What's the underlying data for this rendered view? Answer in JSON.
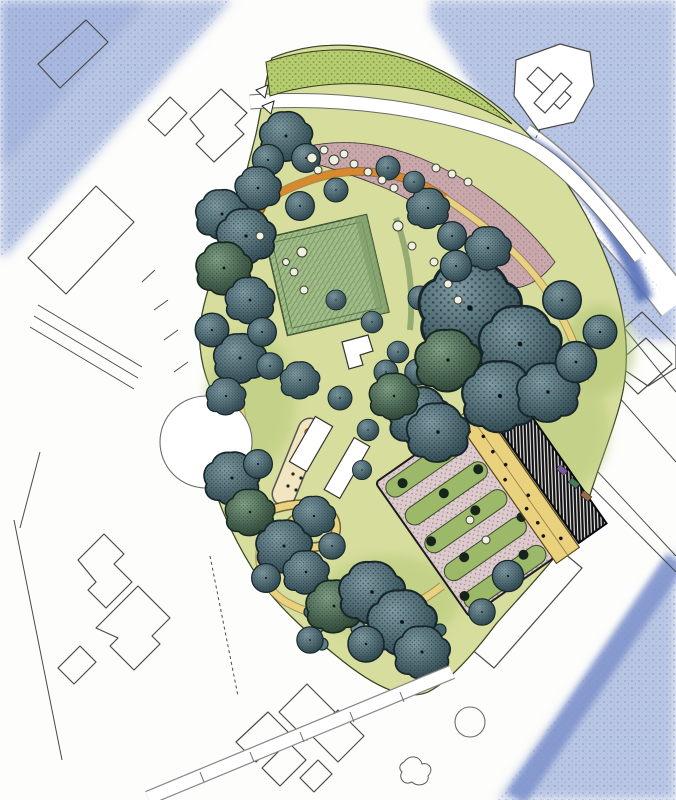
{
  "canvas": {
    "width": 676,
    "height": 800,
    "background": "#fdfdfb"
  },
  "palette": {
    "paper": "#fdfdfb",
    "blue_light": "#b9c6e3",
    "blue_mid": "#8ba0d2",
    "blue_deep": "#5570b8",
    "context_line": "#4a4a46",
    "grass": "#d7dd9c",
    "grass_stipple": "#79883f",
    "bank_green": "#b5cc6f",
    "lawn": "#a3bd88",
    "lawn_hatch": "#6f9160",
    "tree_light": "#7e9aa2",
    "tree_mid": "#4a656d",
    "tree_dark": "#233940",
    "tree_green_light": "#7fa083",
    "tree_green_mid": "#47634f",
    "tree_green_dark": "#24382b",
    "path_yellow": "#ead17d",
    "path_orange": "#d8892d",
    "path_edge": "#6b5a2c",
    "pink_planting": "#c9a6ac",
    "stripe_green": "#9bb968",
    "stripe_pink": "#dccacc",
    "dark_building": "#0d0f16",
    "white": "#ffffff"
  },
  "plan": {
    "type": "hand-rendered-landscape-masterplan",
    "feature_names": [
      "pencil-shaded-surroundings",
      "context-building-blocks",
      "perimeter-roads",
      "park-meadow",
      "event-lawn",
      "entrance-ornamental-planting",
      "winding-orange-path",
      "yellow-park-paths",
      "play-pad",
      "serpentine-mound-path",
      "stripe-garden-beds",
      "terrace-walk",
      "dark-hatched-building",
      "tree-canopies",
      "shrub-masses",
      "roundabout-circle",
      "small-tree-ring"
    ],
    "trees": [
      [
        286,
        136,
        0.8,
        "A"
      ],
      [
        268,
        160,
        0.65,
        "B"
      ],
      [
        306,
        158,
        0.6,
        "B"
      ],
      [
        258,
        188,
        0.7,
        "A"
      ],
      [
        222,
        214,
        0.8,
        "A"
      ],
      [
        246,
        236,
        0.9,
        "A"
      ],
      [
        224,
        268,
        0.85,
        "G"
      ],
      [
        250,
        300,
        0.75,
        "A"
      ],
      [
        212,
        330,
        0.7,
        "B"
      ],
      [
        240,
        358,
        0.8,
        "A"
      ],
      [
        262,
        332,
        0.6,
        "B"
      ],
      [
        270,
        366,
        0.55,
        "B"
      ],
      [
        226,
        396,
        0.6,
        "A"
      ],
      [
        300,
        206,
        0.6,
        "B"
      ],
      [
        336,
        190,
        0.5,
        "B"
      ],
      [
        428,
        208,
        0.65,
        "A"
      ],
      [
        452,
        236,
        0.6,
        "B"
      ],
      [
        336,
        300,
        0.42,
        "B"
      ],
      [
        372,
        322,
        0.45,
        "B"
      ],
      [
        420,
        298,
        0.5,
        "B"
      ],
      [
        398,
        352,
        0.45,
        "B"
      ],
      [
        300,
        380,
        0.6,
        "A"
      ],
      [
        340,
        398,
        0.5,
        "B"
      ],
      [
        368,
        430,
        0.45,
        "B"
      ],
      [
        386,
        372,
        0.5,
        "B"
      ],
      [
        418,
        372,
        0.55,
        "B"
      ],
      [
        470,
        308,
        1.55,
        "A"
      ],
      [
        520,
        344,
        1.25,
        "A"
      ],
      [
        448,
        360,
        1.0,
        "G"
      ],
      [
        500,
        396,
        1.15,
        "A"
      ],
      [
        548,
        392,
        0.95,
        "A"
      ],
      [
        576,
        362,
        0.85,
        "B"
      ],
      [
        562,
        300,
        0.8,
        "B"
      ],
      [
        600,
        332,
        0.7,
        "B"
      ],
      [
        488,
        248,
        0.7,
        "A"
      ],
      [
        456,
        266,
        0.65,
        "B"
      ],
      [
        388,
        168,
        0.5,
        "B"
      ],
      [
        414,
        182,
        0.45,
        "B"
      ],
      [
        420,
        416,
        0.95,
        "A"
      ],
      [
        394,
        396,
        0.75,
        "G"
      ],
      [
        438,
        432,
        0.95,
        "A"
      ],
      [
        314,
        516,
        0.65,
        "A"
      ],
      [
        332,
        546,
        0.55,
        "B"
      ],
      [
        362,
        470,
        0.4,
        "B"
      ],
      [
        232,
        478,
        0.85,
        "A"
      ],
      [
        258,
        464,
        0.6,
        "B"
      ],
      [
        250,
        512,
        0.75,
        "G"
      ],
      [
        284,
        546,
        0.85,
        "A"
      ],
      [
        266,
        578,
        0.6,
        "B"
      ],
      [
        306,
        572,
        0.7,
        "A"
      ],
      [
        334,
        606,
        0.85,
        "G"
      ],
      [
        372,
        592,
        1.0,
        "A"
      ],
      [
        402,
        622,
        1.05,
        "A"
      ],
      [
        366,
        644,
        0.75,
        "B"
      ],
      [
        422,
        652,
        0.85,
        "A"
      ],
      [
        310,
        640,
        0.55,
        "B"
      ],
      [
        508,
        576,
        0.65,
        "B"
      ],
      [
        482,
        612,
        0.55,
        "B"
      ]
    ],
    "shrubs": [
      [
        332,
        596,
        7
      ],
      [
        346,
        588,
        6
      ],
      [
        358,
        600,
        8
      ],
      [
        344,
        614,
        7
      ],
      [
        330,
        626,
        6
      ],
      [
        358,
        628,
        7
      ],
      [
        372,
        616,
        8
      ],
      [
        386,
        604,
        7
      ],
      [
        384,
        628,
        8
      ],
      [
        398,
        616,
        7
      ],
      [
        370,
        640,
        7
      ],
      [
        398,
        640,
        8
      ],
      [
        412,
        628,
        7
      ],
      [
        412,
        652,
        7
      ],
      [
        426,
        640,
        8
      ],
      [
        428,
        620,
        6
      ],
      [
        440,
        630,
        6
      ],
      [
        426,
        660,
        6
      ],
      [
        440,
        652,
        5
      ],
      [
        310,
        612,
        6
      ],
      [
        318,
        628,
        5
      ],
      [
        322,
        644,
        6
      ]
    ],
    "rings": [
      [
        302,
        252,
        5
      ],
      [
        294,
        272,
        4
      ],
      [
        304,
        290,
        4
      ],
      [
        286,
        262,
        3.5
      ],
      [
        398,
        226,
        5
      ],
      [
        412,
        246,
        4
      ],
      [
        434,
        262,
        4
      ],
      [
        448,
        284,
        4
      ],
      [
        458,
        300,
        4
      ],
      [
        260,
        236,
        4
      ],
      [
        470,
        520,
        4
      ],
      [
        486,
        540,
        4
      ],
      [
        436,
        168,
        4
      ],
      [
        452,
        174,
        4
      ],
      [
        468,
        182,
        4
      ],
      [
        312,
        158,
        5
      ],
      [
        324,
        150,
        4
      ],
      [
        334,
        160,
        5
      ],
      [
        318,
        170,
        4
      ],
      [
        344,
        154,
        4
      ],
      [
        354,
        164,
        4
      ],
      [
        368,
        172,
        4
      ],
      [
        382,
        180,
        4
      ],
      [
        394,
        188,
        4
      ]
    ],
    "strip_dots": [
      [
        -30,
        -66
      ],
      [
        22,
        -66
      ],
      [
        -2,
        -34
      ],
      [
        40,
        -34
      ],
      [
        -40,
        -2
      ],
      [
        14,
        -2
      ],
      [
        48,
        30
      ],
      [
        -22,
        30
      ],
      [
        28,
        62
      ],
      [
        -44,
        62
      ]
    ],
    "terrace_dots": [
      [
        54,
        -70
      ],
      [
        62,
        -40
      ],
      [
        56,
        -10
      ],
      [
        66,
        16
      ],
      [
        58,
        44
      ],
      [
        68,
        70
      ],
      [
        63,
        -58
      ],
      [
        57,
        26
      ],
      [
        65,
        -22
      ],
      [
        55,
        58
      ]
    ],
    "pad_dots": [
      [
        288,
        486
      ],
      [
        293,
        474
      ],
      [
        298,
        462
      ],
      [
        303,
        450
      ],
      [
        306,
        438
      ],
      [
        296,
        490
      ],
      [
        301,
        478
      ],
      [
        306,
        466
      ]
    ],
    "cars": [
      [
        562,
        470,
        "#7a5a9a"
      ],
      [
        574,
        483,
        "#4a7a5a"
      ],
      [
        586,
        496,
        "#9a6a4a"
      ]
    ],
    "buildings": [
      {
        "pts": "38,64 86,20 108,42 60,88",
        "fill": "none"
      },
      {
        "pts": "148,120 170,97 187,113 165,136",
        "fill": "none"
      },
      {
        "pts": "190,119 221,89 247,113 235,125 244,134 214,162 196,144 204,136",
        "fill": "none"
      },
      {
        "pts": "28,258 96,186 134,222 66,294",
        "fill": "none"
      },
      {
        "pts": "78,560 104,534 124,554 114,564 132,582 106,608 88,590 96,582",
        "fill": "none"
      },
      {
        "pts": "96,628 138,586 170,618 152,636 160,644 134,670 110,646 118,638",
        "fill": "none"
      },
      {
        "pts": "58,668 80,646 96,662 74,684",
        "fill": "none"
      },
      {
        "pts": "236,742 268,712 288,732 256,762",
        "fill": "none"
      },
      {
        "pts": "262,768 288,742 306,760 280,786",
        "fill": "none"
      },
      {
        "pts": "300,778 318,760 332,774 314,792",
        "fill": "none"
      },
      {
        "pts": "307,684 335,712 307,740 279,712",
        "fill": "none"
      },
      {
        "pts": "338,710 364,736 338,762 312,736",
        "fill": "none"
      },
      {
        "pts": "516,60 560,44 590,52 594,86 574,122 538,130 514,96",
        "fill": "#ffffff"
      },
      {
        "pts": "560,109 571,97 538,67 527,79",
        "fill": "#ffffff"
      },
      {
        "pts": "545,113 534,103 561,73 572,83",
        "fill": "#ffffff"
      },
      {
        "pts": "612,368 646,338 672,364 638,394",
        "fill": "none"
      },
      {
        "pts": "598,352 642,312 676,346 676,368 648,386",
        "fill": "none"
      },
      {
        "pts": "470,648 558,548 582,568 494,668",
        "fill": "none"
      }
    ],
    "context_lines": [
      {
        "pts": "38,305 142,367",
        "dash": false
      },
      {
        "pts": "34,316 138,378",
        "dash": false
      },
      {
        "pts": "30,327 134,389",
        "dash": false
      },
      {
        "pts": "14,520 62,760",
        "dash": false
      },
      {
        "pts": "40,452 20,528",
        "dash": false
      },
      {
        "pts": "210,556 238,696",
        "dash": true
      },
      {
        "pts": "560,330 676,462",
        "dash": false
      },
      {
        "pts": "600,298 676,392",
        "dash": false
      },
      {
        "pts": "560,455 676,572",
        "dash": false
      },
      {
        "pts": "572,444 676,556",
        "dash": false
      },
      {
        "pts": "540,130 520,168",
        "dash": true
      },
      {
        "pts": "155,270 142,282",
        "dash": false
      },
      {
        "pts": "168,300 154,310",
        "dash": false
      },
      {
        "pts": "178,330 164,340",
        "dash": false
      },
      {
        "pts": "188,362 174,372",
        "dash": false
      }
    ]
  }
}
